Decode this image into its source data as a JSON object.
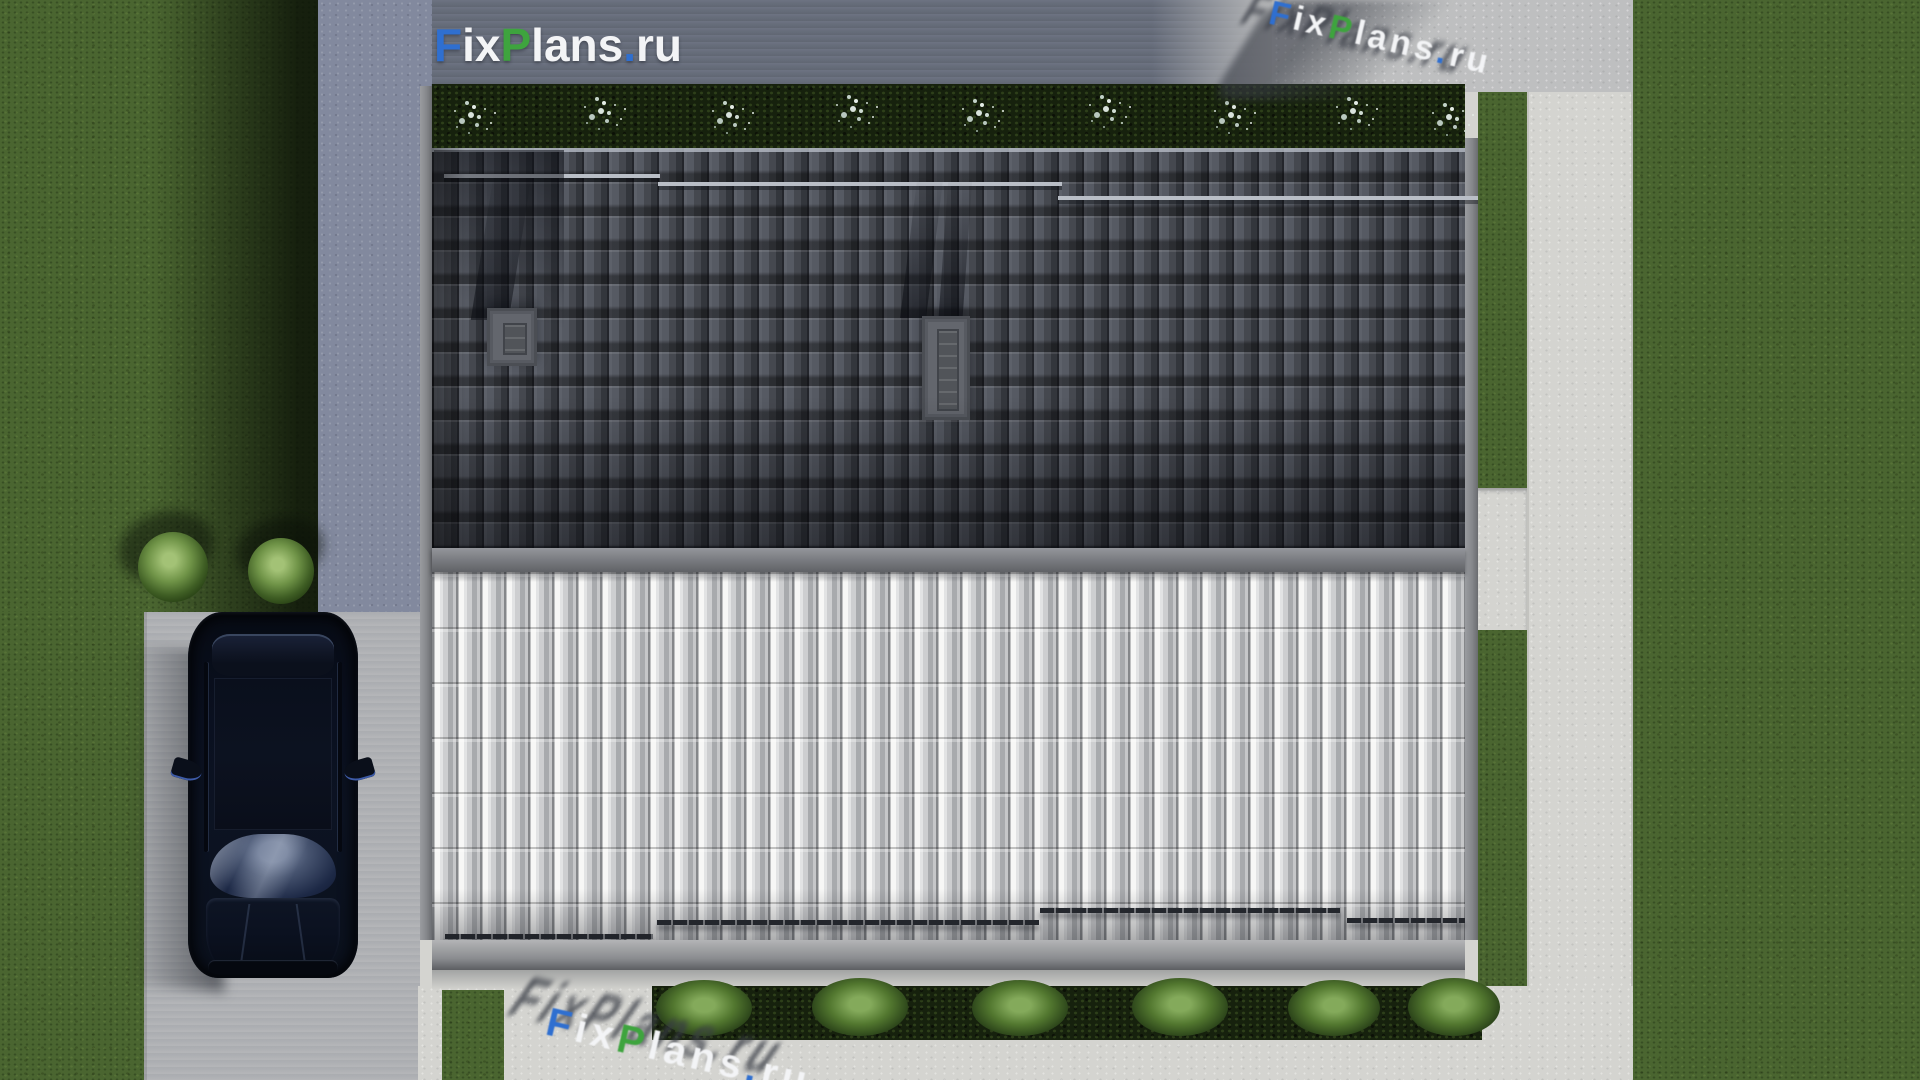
{
  "watermark": {
    "text": "FixPlans.ru",
    "segments": [
      {
        "text": "F",
        "color": "#2f6fd0"
      },
      {
        "text": "ix",
        "color": "#f3f4f6"
      },
      {
        "text": "P",
        "color": "#3ea43e"
      },
      {
        "text": "lans",
        "color": "#f3f4f6"
      },
      {
        "text": ".",
        "color": "#2f6fd0"
      },
      {
        "text": "ru",
        "color": "#f3f4f6"
      }
    ]
  },
  "palette": {
    "brandBlue": "#2f6fd0",
    "brandGreen": "#3ea43e",
    "grassBase": "#4a6530",
    "grassShadow": "#121b0a",
    "concShade": "#82899e",
    "concSun": "#d4d4d0",
    "roofDarkA": "#565a63",
    "roofDarkGap": "#23252b",
    "roofLightHi": "#f7f7f6",
    "roofLightMid": "#cdced0",
    "roofLightLo": "#85878a",
    "fascia": "#85878b",
    "ridgeA": "#94969b",
    "ridgeB": "#606266",
    "hedge": "#16210d",
    "bushA": "#84aa5b",
    "bushB": "#2c451a",
    "carBody": "#0a101c"
  }
}
